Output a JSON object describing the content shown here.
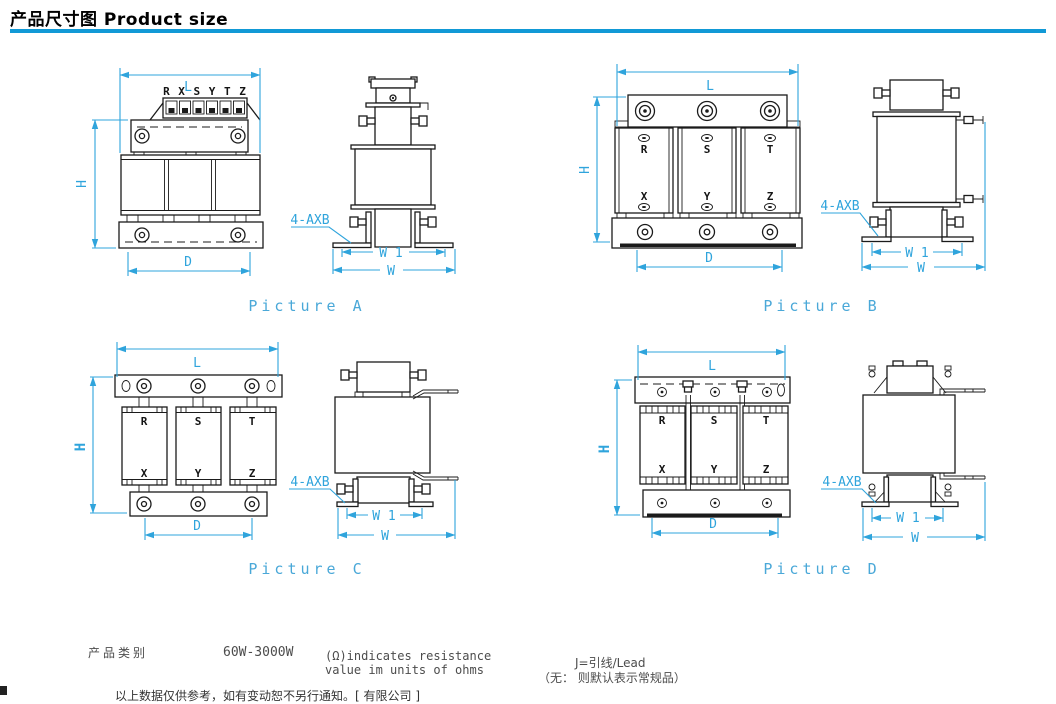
{
  "header": {
    "title": "产品尺寸图 Product size"
  },
  "dims": {
    "L": "L",
    "H": "H",
    "D": "D",
    "W": "W",
    "W1": "W 1",
    "mount_note": "4-AXB"
  },
  "phases": {
    "R": "R",
    "S": "S",
    "T": "T",
    "X": "X",
    "Y": "Y",
    "Z": "Z"
  },
  "pictures": [
    {
      "id": "A",
      "caption": "Picture A",
      "terminal_row": "R X S Y T Z"
    },
    {
      "id": "B",
      "caption": "Picture B"
    },
    {
      "id": "C",
      "caption": "Picture C"
    },
    {
      "id": "D",
      "caption": "Picture D"
    }
  ],
  "footer": {
    "category_label": "产品类别",
    "category_value": "60W-3000W",
    "resistance_note_line1": "(Ω)indicates resistance",
    "resistance_note_line2": "value im units of ohms",
    "lead_note": "J=引线/Lead",
    "default_note": "（无： 则默认表示常规品）",
    "disclaimer_clipped": "以上数据仅供参考，如有变动恕不另行通知。[ 有限公司 ]"
  },
  "colors": {
    "dimension": "#2fa4dc",
    "caption": "#4aa8d8",
    "title_rule": "#1199d6",
    "line": "#1b1b1b"
  }
}
